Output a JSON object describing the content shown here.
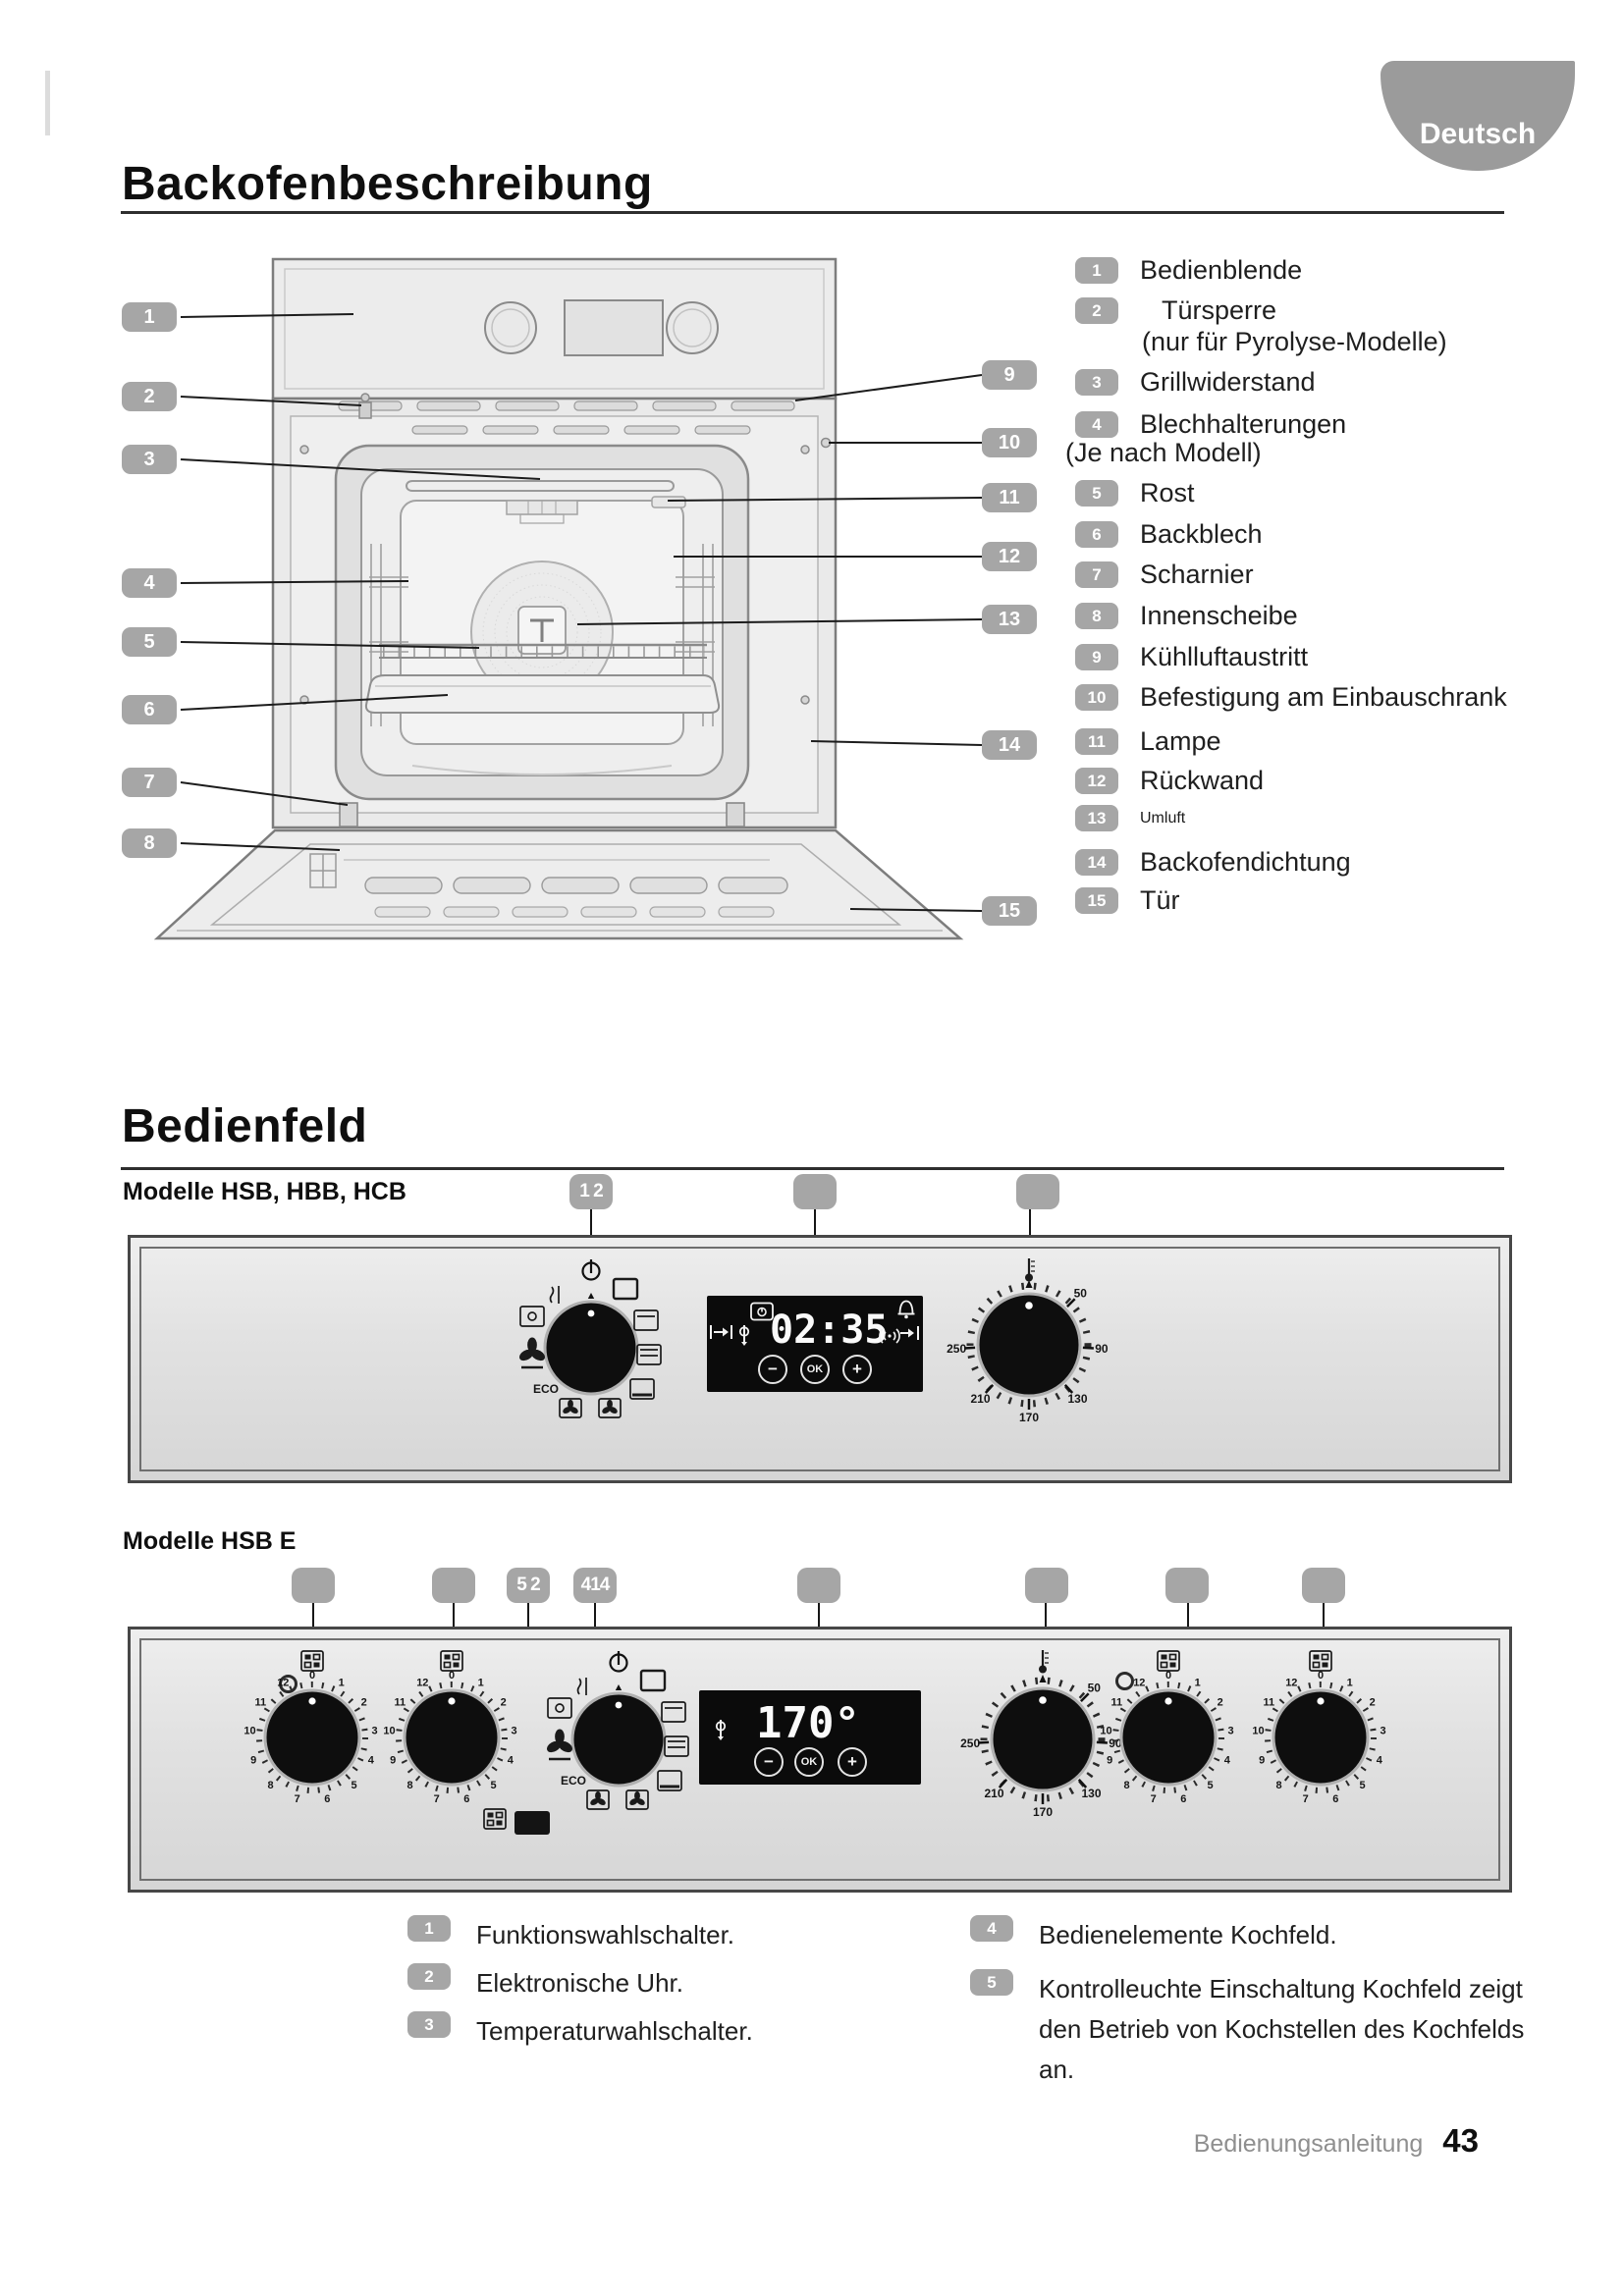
{
  "page": {
    "language_badge": "Deutsch",
    "footer_label": "Bedienungsanleitung",
    "footer_page": "43"
  },
  "oven": {
    "title": "Backofenbeschreibung",
    "parts": [
      {
        "n": "1",
        "label": "Bedienblende"
      },
      {
        "n": "2",
        "label": "Türsperre",
        "note": "(nur für Pyrolyse-Modelle)"
      },
      {
        "n": "3",
        "label": "Grillwiderstand"
      },
      {
        "n": "4",
        "label": "Blechhalterungen",
        "note": "(Je nach Modell)"
      },
      {
        "n": "5",
        "label": "Rost"
      },
      {
        "n": "6",
        "label": "Backblech"
      },
      {
        "n": "7",
        "label": "Scharnier"
      },
      {
        "n": "8",
        "label": "Innenscheibe"
      },
      {
        "n": "9",
        "label": "Kühlluftaustritt"
      },
      {
        "n": "10",
        "label": "Befestigung am Einbauschrank"
      },
      {
        "n": "11",
        "label": "Lampe"
      },
      {
        "n": "12",
        "label": "Rückwand"
      },
      {
        "n": "13",
        "label": "Umluft"
      },
      {
        "n": "14",
        "label": "Backofendichtung"
      },
      {
        "n": "15",
        "label": "Tür"
      }
    ]
  },
  "bedienfeld": {
    "title": "Bedienfeld",
    "model1_label": "Modelle HSB, HBB, HCB",
    "model2_label": "Modelle HSB E",
    "panel1_badges": [
      "1 2",
      "",
      ""
    ],
    "panel2_badges": [
      "",
      "",
      "5 2",
      "414",
      "",
      "",
      "",
      ""
    ],
    "display1": {
      "time": "02:35",
      "minus": "−",
      "ok": "OK",
      "plus": "+"
    },
    "display2": {
      "temp": "170°",
      "minus": "−",
      "ok": "OK",
      "plus": "+"
    },
    "temp_scale": [
      "50",
      "90",
      "130",
      "170",
      "210",
      "250"
    ],
    "hob_scale": [
      "0",
      "1",
      "2",
      "3",
      "4",
      "5",
      "6",
      "7",
      "8",
      "9",
      "10",
      "11",
      "12"
    ],
    "eco_label": "ECO",
    "legend": [
      {
        "n": "1",
        "text": "Funktionswahlschalter."
      },
      {
        "n": "2",
        "text": "Elektronische Uhr."
      },
      {
        "n": "3",
        "text": "Temperaturwahlschalter."
      },
      {
        "n": "4",
        "text": "Bedienelemente Kochfeld."
      },
      {
        "n": "5",
        "text": "Kontrolleuchte Einschaltung Kochfeld zeigt den Betrieb von Kochstellen des Kochfelds an."
      }
    ]
  }
}
